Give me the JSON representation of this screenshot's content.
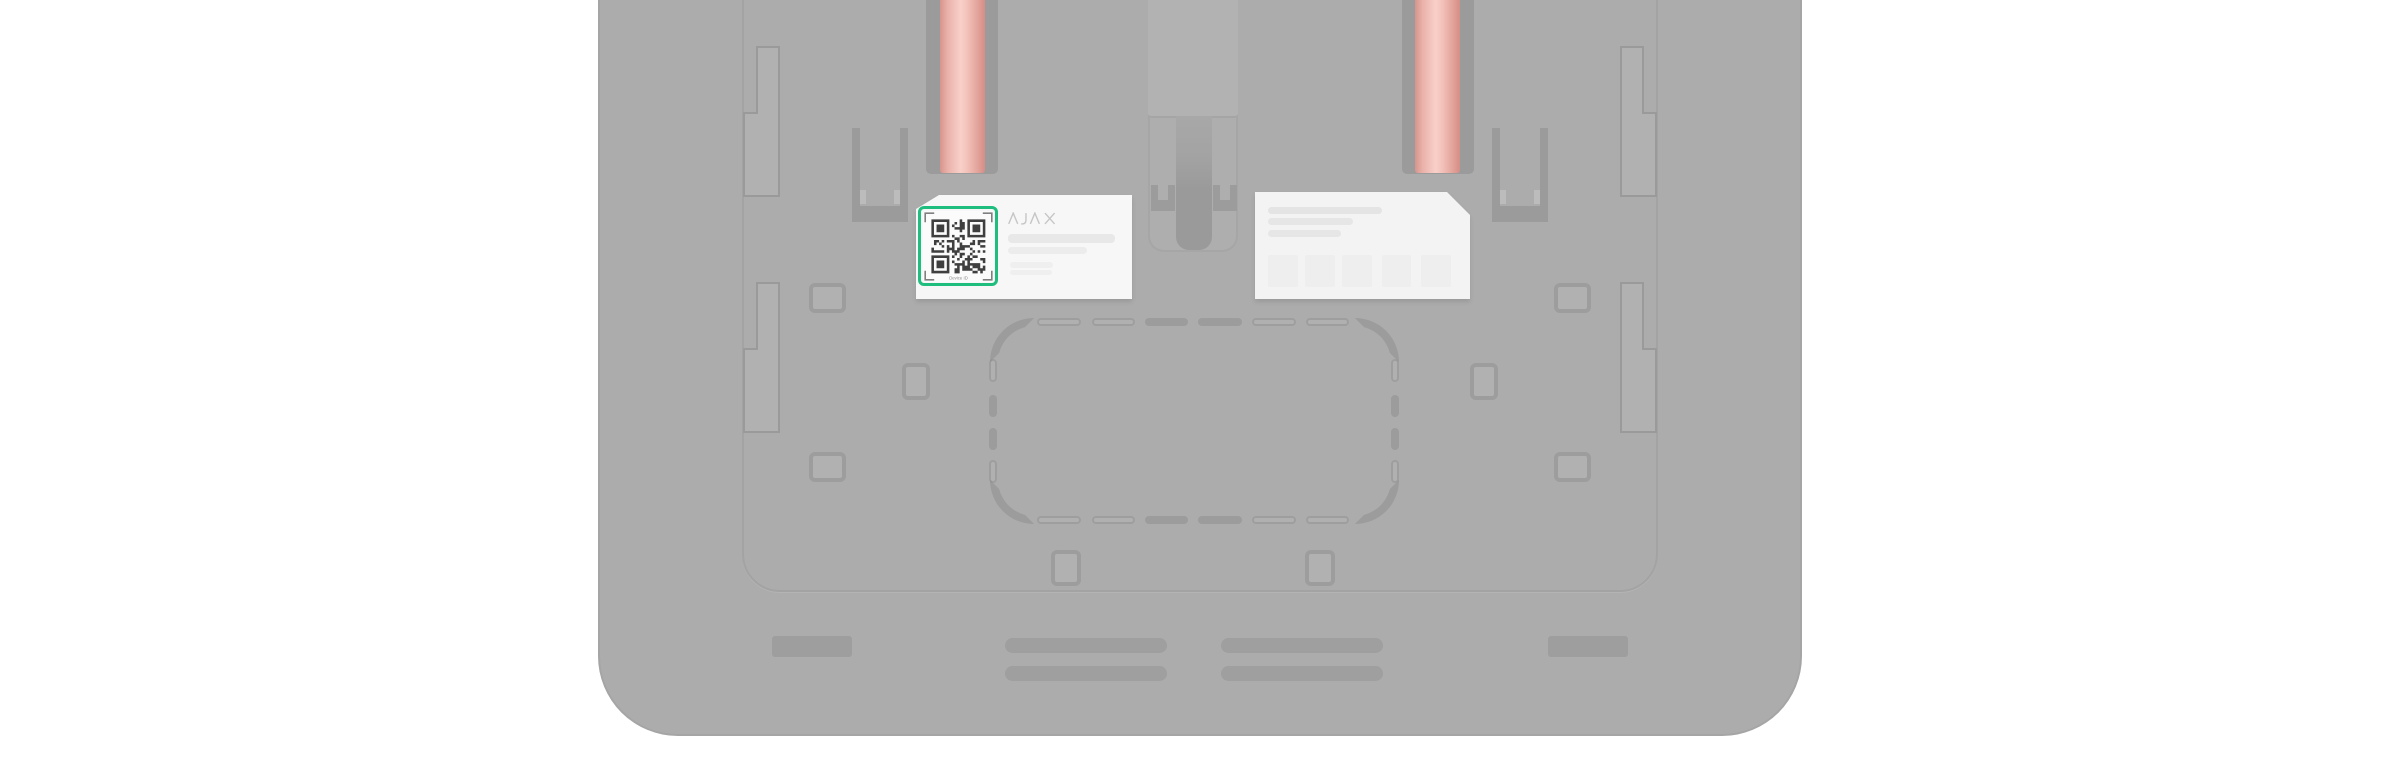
{
  "scene": {
    "name": "ajax-device-back-panel-qr-highlight",
    "description": "Back of an Ajax device with two red cables routed through channels; the QR code on the device sticker is highlighted with a green frame",
    "labels": {
      "device_label": {
        "brand": "AJAX",
        "qr_caption": "Device ID"
      }
    },
    "highlight": {
      "target": "device-id-qr-code",
      "color": "#1fbe7e"
    },
    "colors": {
      "page_background": "#ffffff",
      "panel_gray": "#acacac",
      "recess_gray": "#9b9b9b",
      "sticker_white": "#f7f7f7",
      "cable_pink": "#f8d0c9",
      "cable_edge": "#d6958d",
      "qr_dark": "#3f3f3f",
      "highlight_green": "#1fbe7e"
    }
  }
}
